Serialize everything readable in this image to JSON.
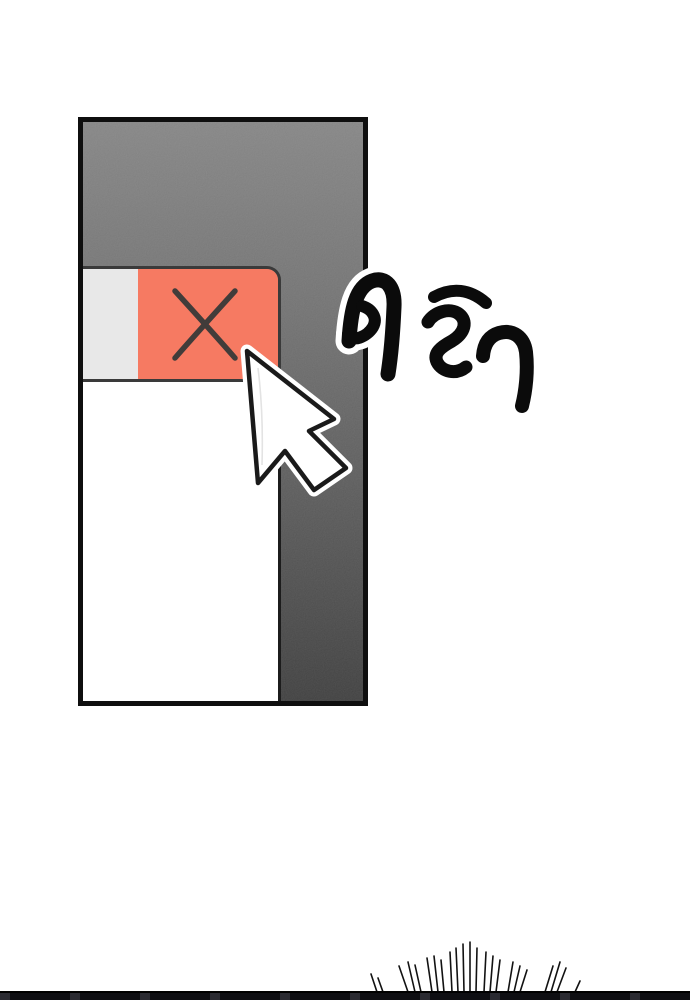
{
  "sfx": {
    "text": "คลิก",
    "color": "#0b0b0b",
    "outline_color": "#ffffff"
  },
  "panel": {
    "border_color": "#0f0f0f",
    "bg_top": "#7e7e7e",
    "bg_bottom": "#3a3a3a"
  },
  "window": {
    "titlebar_bg": "#e8e8e8",
    "body_bg": "#ffffff",
    "close_button": {
      "glyph": "×",
      "bg": "#f67a62",
      "glyph_color": "#413c3a",
      "outline": "#3a3a3a"
    }
  },
  "cursor": {
    "fill": "#ffffff",
    "outline": "#1a1a1a",
    "halo": "#ffffff"
  },
  "bottom_edge": {
    "bg": "#121216"
  }
}
